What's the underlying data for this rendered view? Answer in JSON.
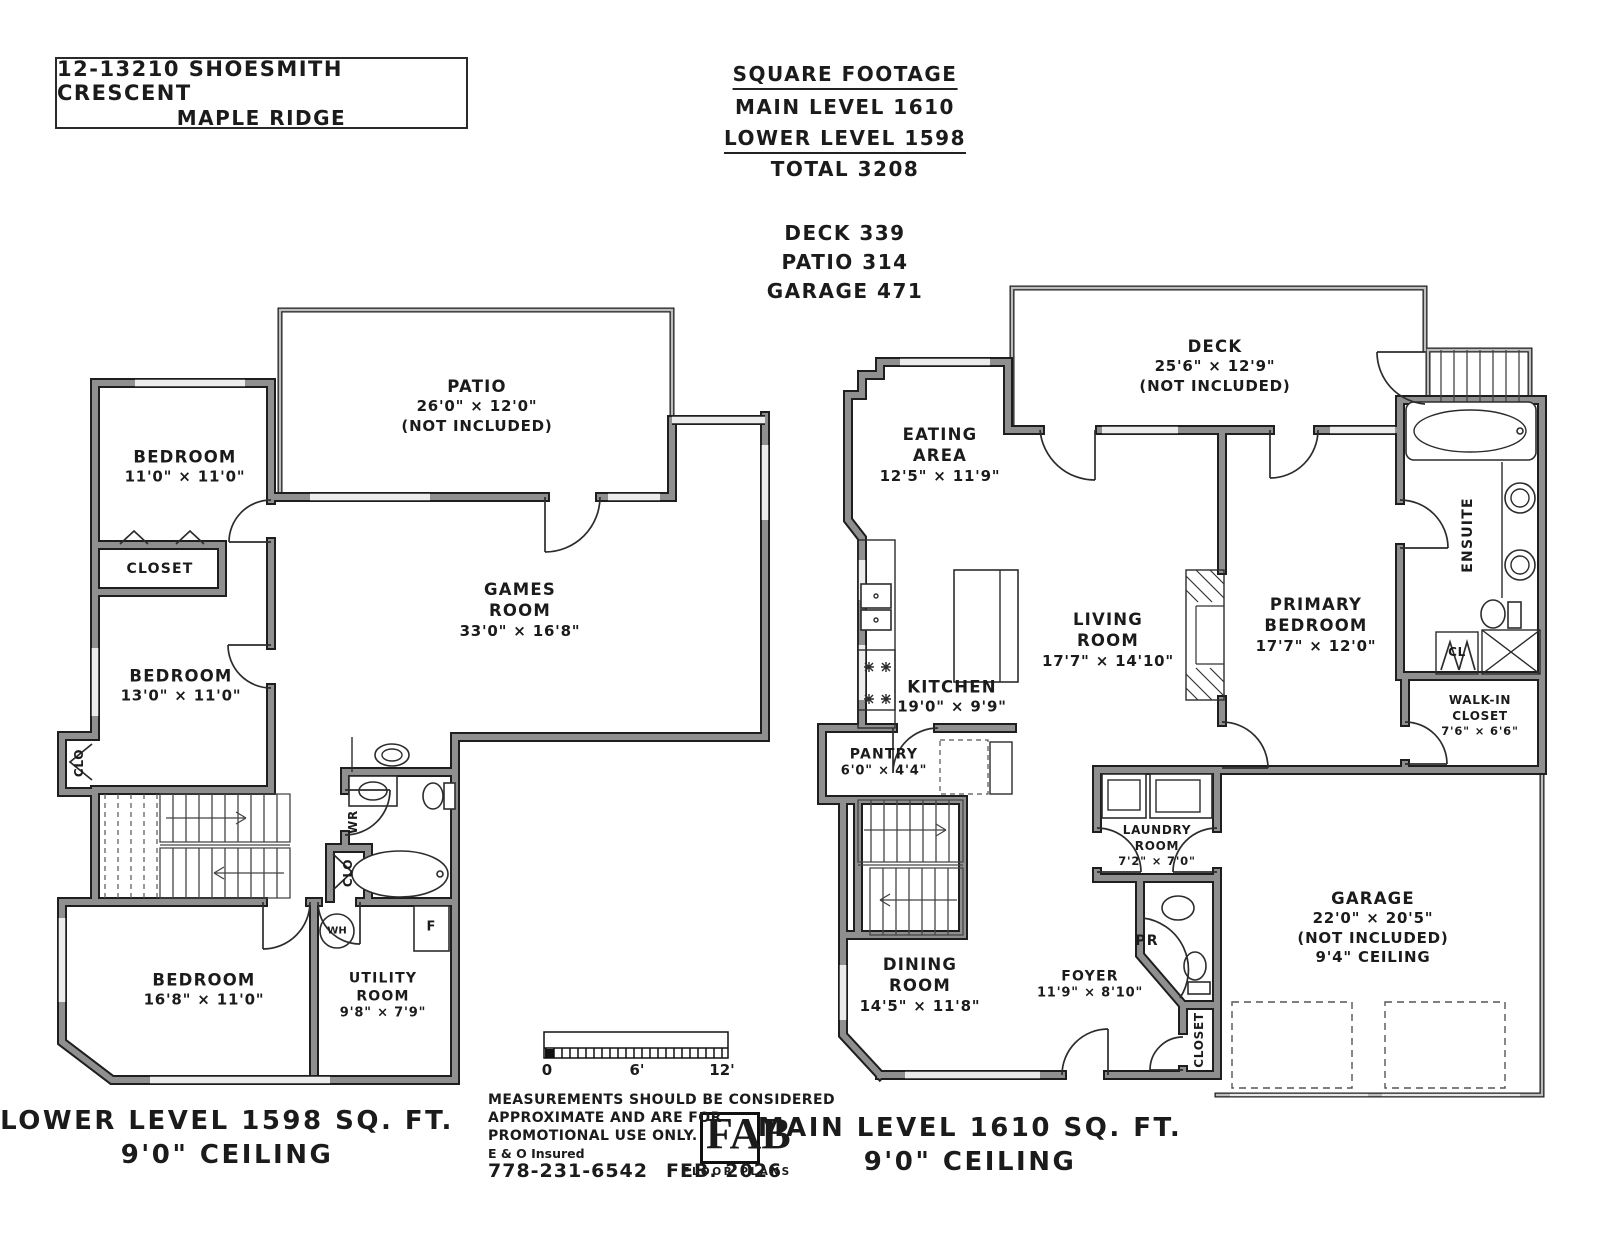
{
  "header": {
    "address1": "12-13210 SHOESMITH CRESCENT",
    "address2": "MAPLE RIDGE",
    "sq_title": "SQUARE FOOTAGE",
    "sq_main": "MAIN LEVEL 1610",
    "sq_lower": "LOWER LEVEL 1598",
    "sq_total": "TOTAL 3208",
    "sq_deck": "DECK 339",
    "sq_patio": "PATIO 314",
    "sq_garage": "GARAGE 471"
  },
  "lower": {
    "cap1": "LOWER LEVEL 1598 SQ. FT.",
    "cap2": "9'0\" CEILING",
    "rooms": {
      "patio": {
        "n": "PATIO",
        "d": "26'0\" × 12'0\"",
        "x": "(NOT INCLUDED)"
      },
      "bedroom1": {
        "n": "BEDROOM",
        "d": "11'0\" × 11'0\""
      },
      "closet": {
        "n": "CLOSET"
      },
      "bedroom2": {
        "n": "BEDROOM",
        "d": "13'0\" × 11'0\""
      },
      "clo1": {
        "n": "CLO"
      },
      "games": {
        "n1": "GAMES",
        "n2": "ROOM",
        "d": "33'0\" × 16'8\""
      },
      "wr": {
        "n": "WR"
      },
      "clo2": {
        "n": "CLO"
      },
      "bedroom3": {
        "n": "BEDROOM",
        "d": "16'8\" × 11'0\""
      },
      "utility": {
        "n1": "UTILITY",
        "n2": "ROOM",
        "d": "9'8\" × 7'9\""
      },
      "wh": {
        "n": "WH"
      },
      "f": {
        "n": "F"
      }
    }
  },
  "main": {
    "cap1": "MAIN LEVEL 1610 SQ. FT.",
    "cap2": "9'0\" CEILING",
    "rooms": {
      "eating": {
        "n1": "EATING",
        "n2": "AREA",
        "d": "12'5\" × 11'9\""
      },
      "deck": {
        "n": "DECK",
        "d": "25'6\" × 12'9\"",
        "x": "(NOT INCLUDED)"
      },
      "kitchen": {
        "n": "KITCHEN",
        "d": "19'0\" × 9'9\""
      },
      "pantry": {
        "n": "PANTRY",
        "d": "6'0\" × 4'4\""
      },
      "living": {
        "n1": "LIVING",
        "n2": "ROOM",
        "d": "17'7\" × 14'10\""
      },
      "primary": {
        "n1": "PRIMARY",
        "n2": "BEDROOM",
        "d": "17'7\" × 12'0\""
      },
      "ensuite": {
        "n": "ENSUITE"
      },
      "cl": {
        "n": "CL"
      },
      "walkin": {
        "n1": "WALK-IN",
        "n2": "CLOSET",
        "d": "7'6\" × 6'6\""
      },
      "laundry": {
        "n1": "LAUNDRY",
        "n2": "ROOM",
        "d": "7'2\" × 7'0\""
      },
      "pr": {
        "n": "PR"
      },
      "foyer": {
        "n": "FOYER",
        "d": "11'9\" × 8'10\""
      },
      "dining": {
        "n1": "DINING",
        "n2": "ROOM",
        "d": "14'5\" × 11'8\""
      },
      "garage": {
        "n": "GARAGE",
        "d": "22'0\" × 20'5\"",
        "x": "(NOT INCLUDED)",
        "c": "9'4\" CEILING"
      },
      "closet": {
        "n": "CLOSET"
      }
    }
  },
  "footer": {
    "scale0": "0",
    "scale6": "6'",
    "scale12": "12'",
    "disc1": "MEASUREMENTS SHOULD BE CONSIDERED",
    "disc2": "APPROXIMATE AND ARE FOR",
    "disc3": "PROMOTIONAL USE ONLY.",
    "eo": "E & O Insured",
    "phone": "778-231-6542",
    "date": "FEB. 2026",
    "logo": "FAB",
    "logo_sub": "FLOOR PLANS"
  }
}
